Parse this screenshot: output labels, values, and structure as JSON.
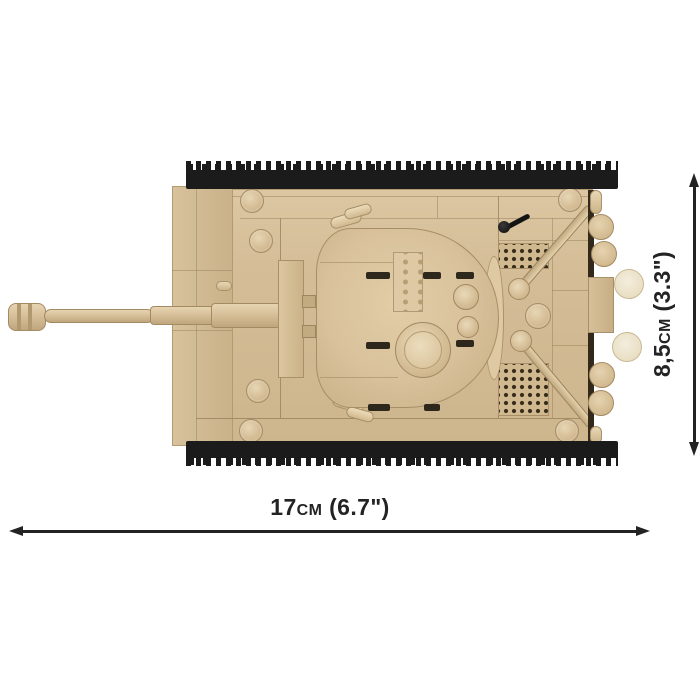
{
  "page": {
    "type": "product-dimension-image",
    "background": "#ffffff",
    "subject": "Brick-built tank model, top view, with size annotations"
  },
  "annotations": {
    "width_label": "17cm (6.7\")",
    "height_label": "8,5cm (3.3\")"
  },
  "colors": {
    "bg": "#ffffff",
    "ink": "#232323",
    "tan": "#d4bd97",
    "tan-light": "#e4d3b1",
    "seam": "#9d8560",
    "cream": "#ece3cc",
    "track": "#1b1b1b",
    "grille-dot": "#362c1b",
    "slot": "#2e281c"
  }
}
